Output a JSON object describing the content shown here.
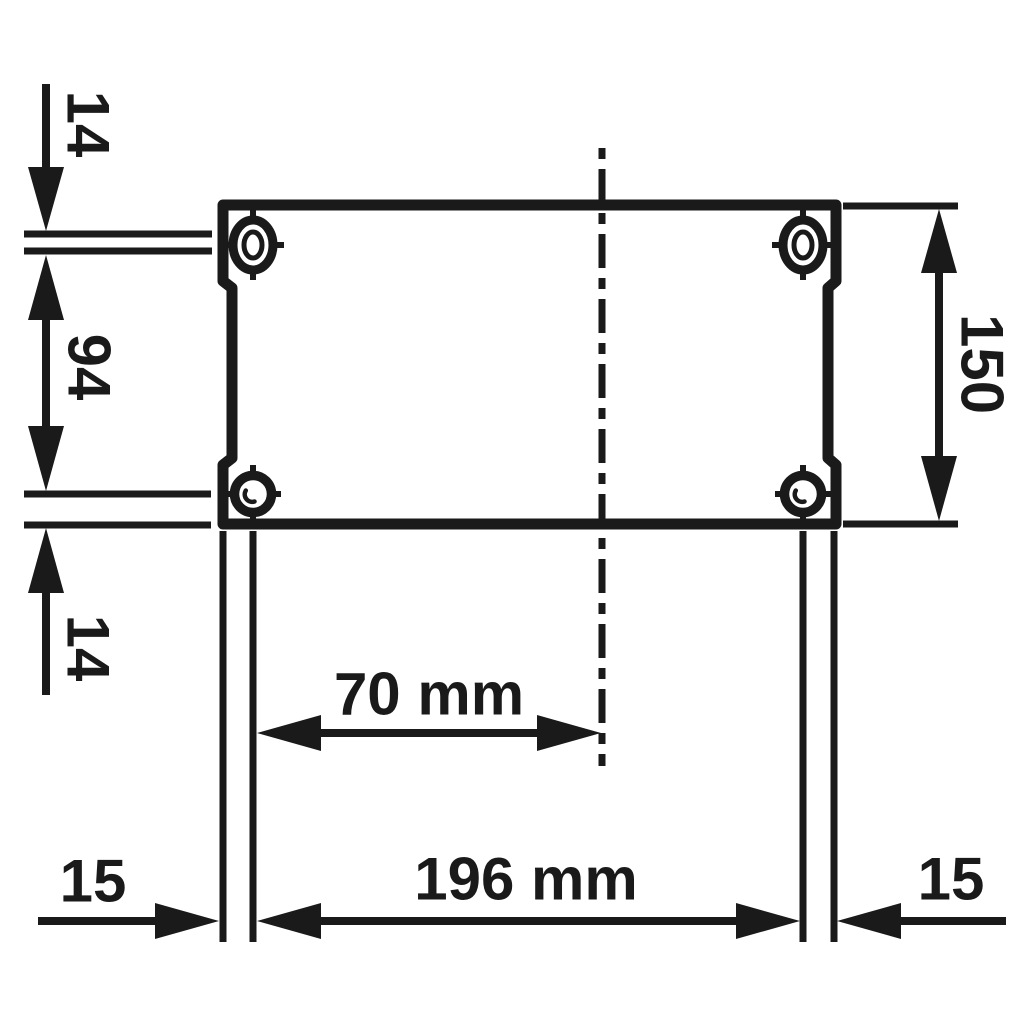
{
  "colors": {
    "ink": "#1a1a1a",
    "background": "#ffffff"
  },
  "labels": {
    "top_edge_to_hole": "14",
    "hole_spacing_vertical": "94",
    "bottom_edge_to_hole": "14",
    "plate_height": "150",
    "hole_to_centerline": "70 mm",
    "hole_spacing_horizontal": "196 mm",
    "left_edge_to_hole": "15",
    "right_edge_to_hole": "15"
  }
}
